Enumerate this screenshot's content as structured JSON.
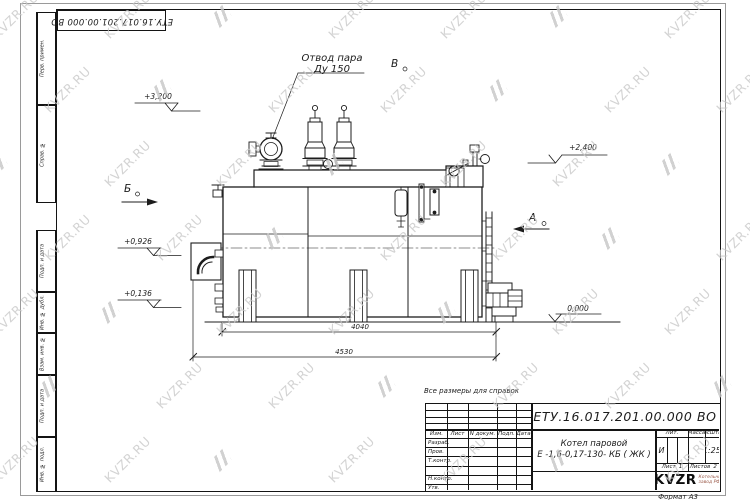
{
  "sheet": {
    "doc_number": "ЕТУ.16.017.201.00.000  ВО",
    "reference_note": "Все размеры для справок",
    "format_label": "Формат А3"
  },
  "watermark": {
    "text": "KVZR.RU"
  },
  "margin_labels": [
    "Перв. примен.",
    "Справ. №",
    "Подп. и дата",
    "Инв. № дубл.",
    "Взам. инв. №",
    "Подп. и дата",
    "Инв. № подл."
  ],
  "title_block": {
    "product_name_line1": "Котел паровой",
    "product_name_line2": "Е -1,6-0,17-130- КБ ( ЖК )",
    "header_cols": [
      "Изм.",
      "Лист",
      "N докум.",
      "Подп.",
      "Дата"
    ],
    "sign_rows": [
      "Разраб.",
      "Пров.",
      "Т.контр.",
      "",
      "Н.контр.",
      "Утв."
    ],
    "lit_label": "Лит.",
    "lit_value": "И",
    "mass_label": "Масса",
    "scale_label": "Масштаб",
    "scale_value": "1:25",
    "sheet_label": "Лист",
    "sheet_value": "1",
    "sheets_label": "Листов",
    "sheets_value": "2",
    "logo_text": "KVZR",
    "logo_caption_line1": "Котельный",
    "logo_caption_line2": "завод РФ"
  },
  "drawing": {
    "callout_line1": "Отвод пара",
    "callout_line2": "Ду 150",
    "view_b": "Б",
    "view_v": "В",
    "view_a": "А",
    "elev_3200": "+3,200",
    "elev_2400": "+2,400",
    "elev_0926": "+0,926",
    "elev_0136": "+0,136",
    "elev_0000": "0,000",
    "dim_4040": "4040",
    "dim_4530": "4530"
  }
}
